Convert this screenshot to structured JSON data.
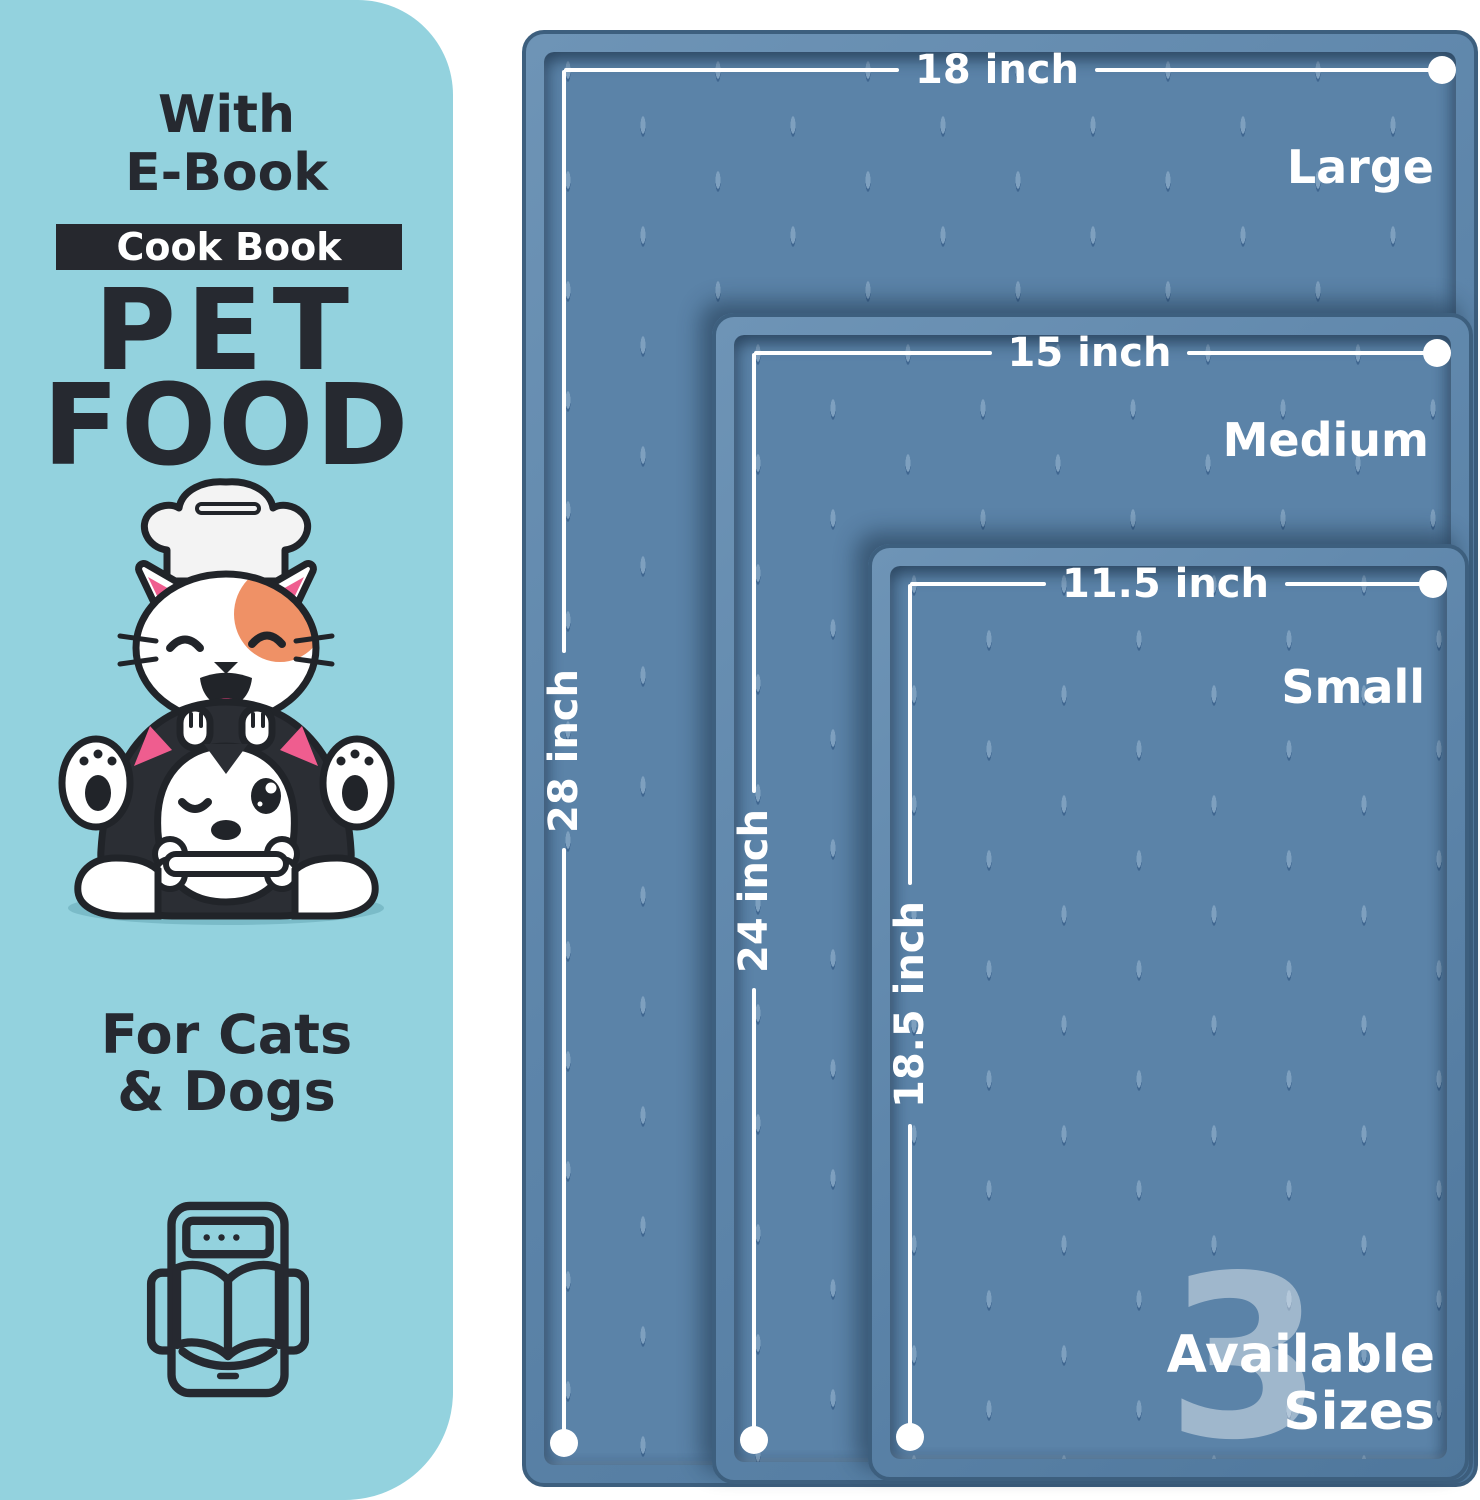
{
  "left_panel": {
    "eyebrow_line1": "With",
    "eyebrow_line2": "E-Book",
    "badge_label": "Cook Book",
    "title_line1": "PET",
    "title_line2": "FOOD",
    "subtitle_line1": "For Cats",
    "subtitle_line2": "& Dogs"
  },
  "mats": {
    "sizes": [
      {
        "name": "Large",
        "width_label": "18 inch",
        "height_label": "28 inch"
      },
      {
        "name": "Medium",
        "width_label": "15 inch",
        "height_label": "24 inch"
      },
      {
        "name": "Small",
        "width_label": "11.5 inch",
        "height_label": "18.5 inch"
      }
    ],
    "availability": {
      "count": "3",
      "word1": "Available",
      "word2": "Sizes"
    }
  },
  "colors": {
    "panel_bg": "#93d2de",
    "ink": "#262930",
    "badge_bg": "#26282e",
    "mat_base": "#5b83a8",
    "mat_rim_dark": "#3d5f7e",
    "dimension_white": "#ffffff",
    "accent_orange": "#ef9166",
    "accent_pink": "#ef5d8f"
  }
}
